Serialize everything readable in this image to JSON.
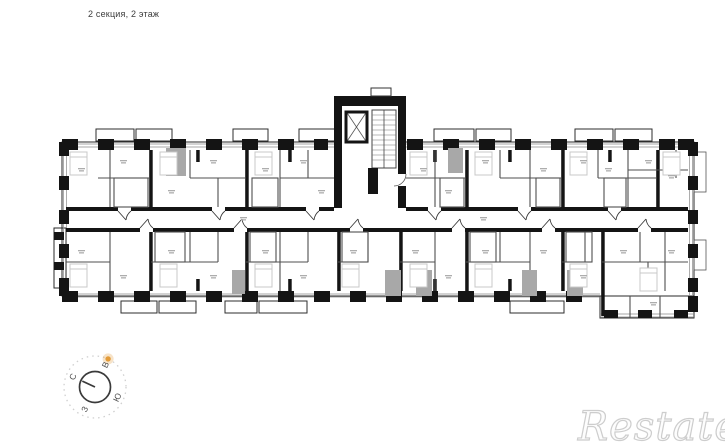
{
  "header": {
    "title": "2 секция, 2 этаж"
  },
  "compass": {
    "north_label": "С",
    "east_label": "В",
    "south_label": "Ю",
    "west_label": "З",
    "accent_color": "#E39B38"
  },
  "watermark": {
    "text": "Restate",
    "color": "#CDCDCD"
  },
  "plan_colors": {
    "wall": "#141414",
    "partition": "#4f4f4f",
    "furniture": "#c8c8c8",
    "shaft": "#a8a8a8",
    "background": "#ffffff"
  }
}
